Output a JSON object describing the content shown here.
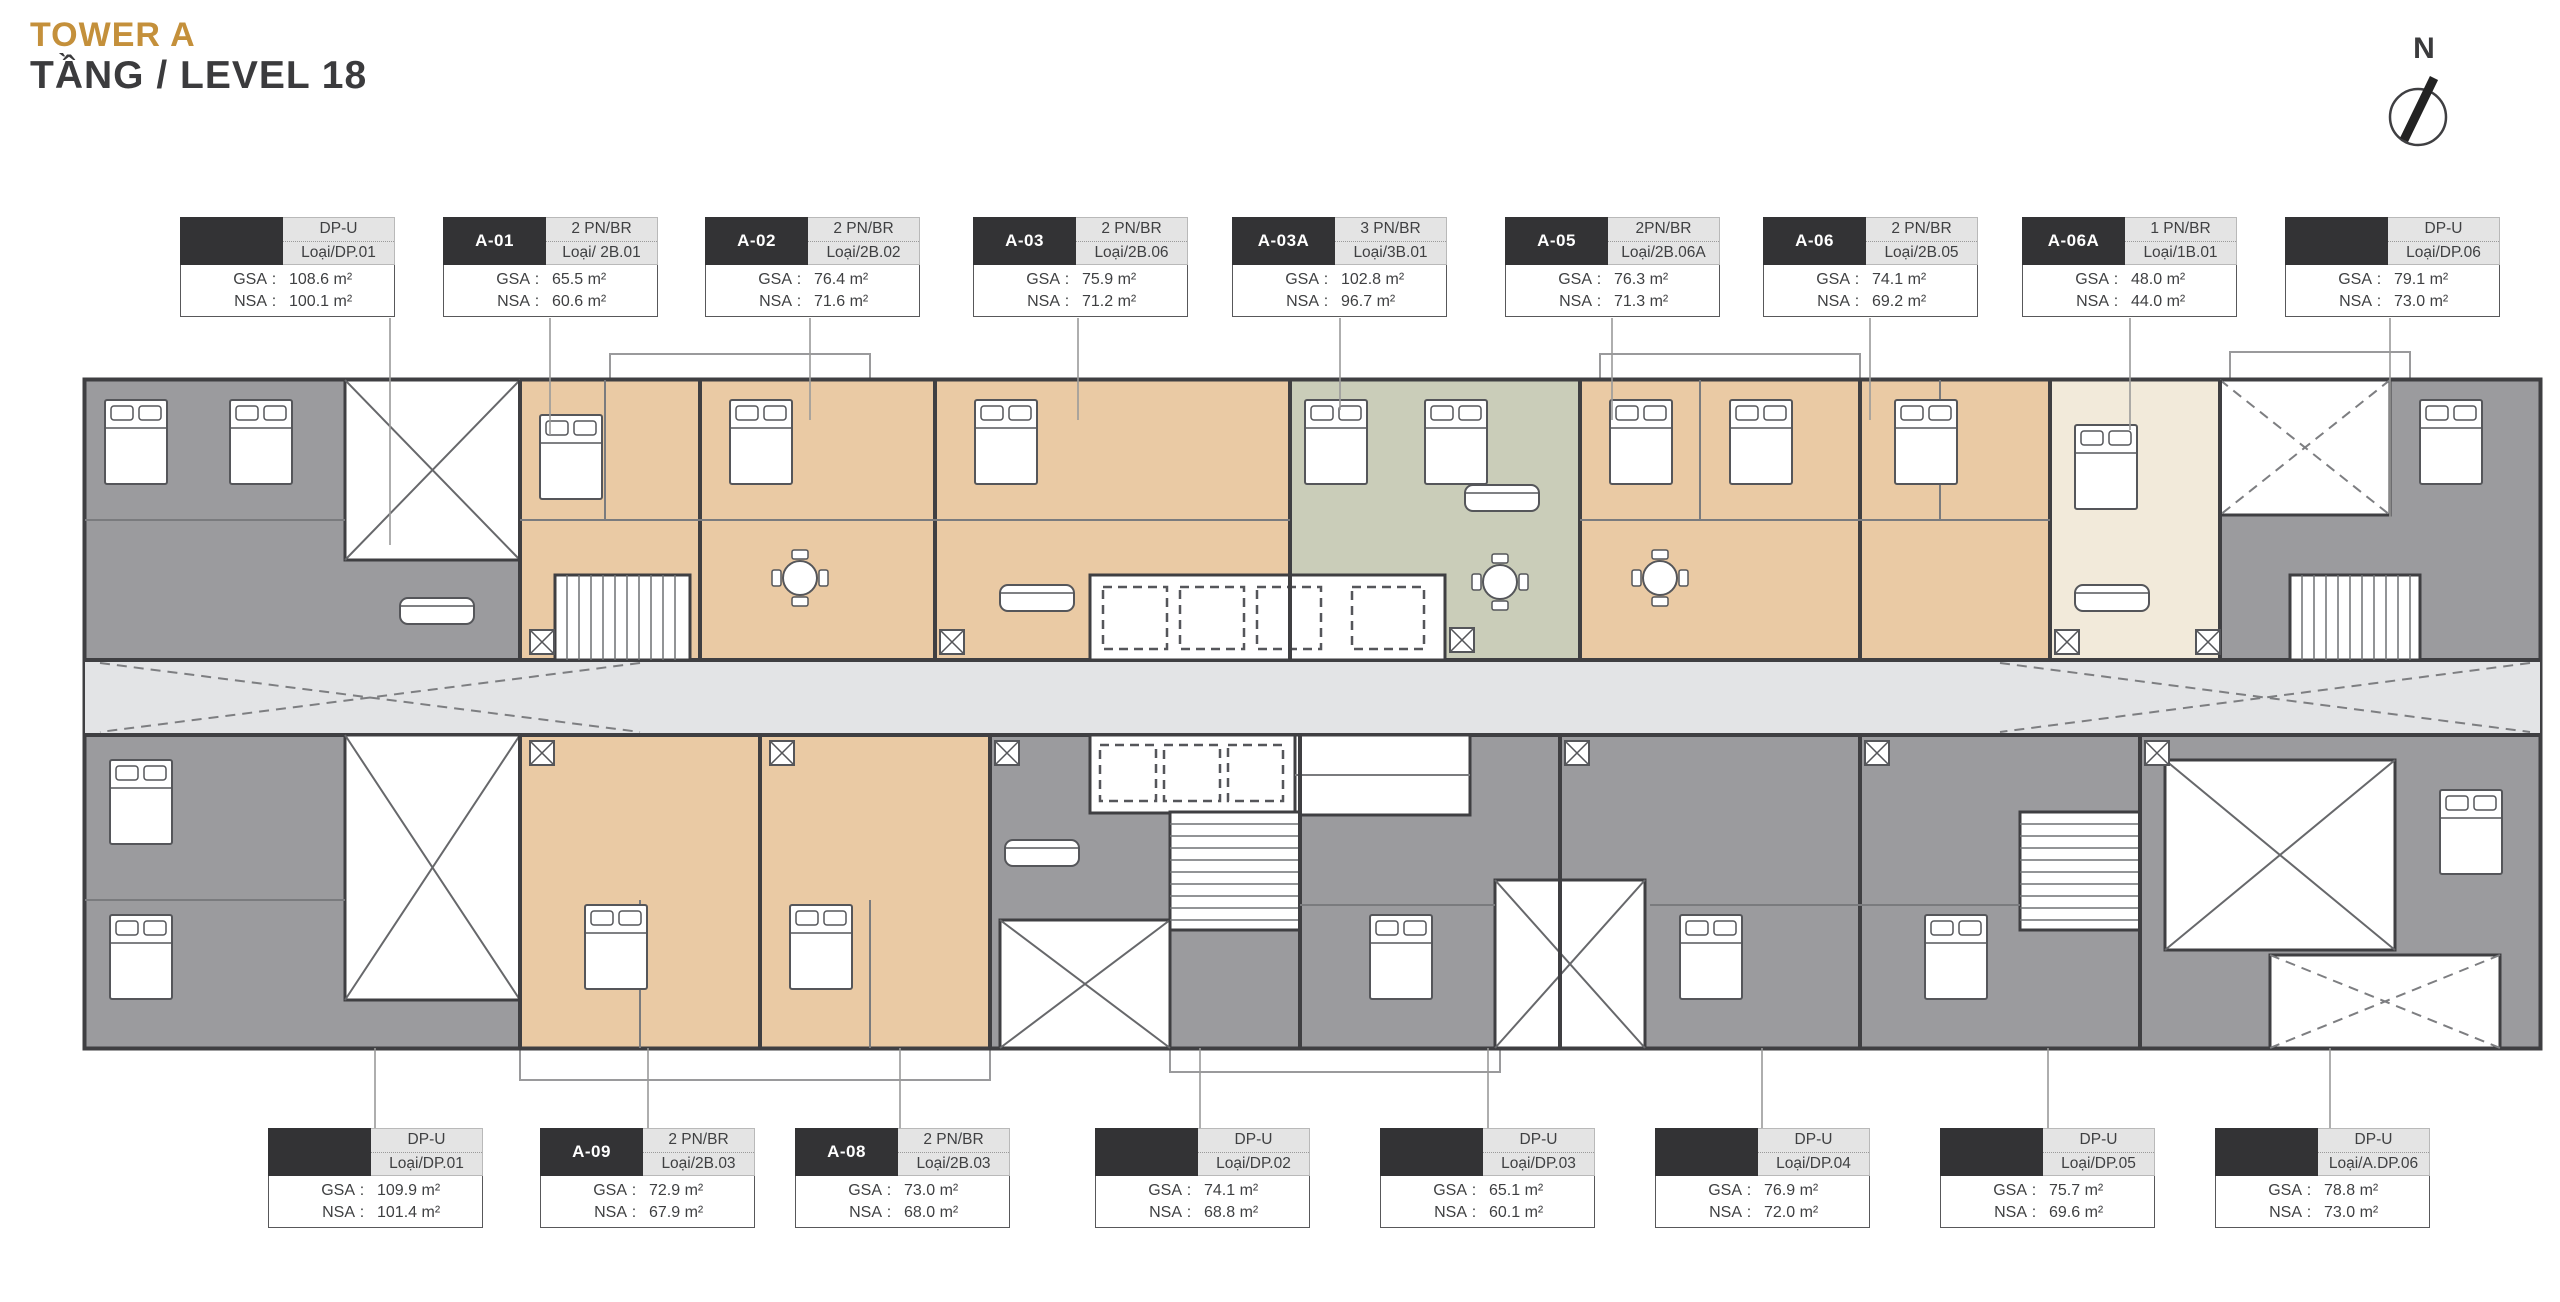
{
  "title": {
    "tower": "TOWER A",
    "level": "TẦNG / LEVEL 18"
  },
  "compass": {
    "label": "N"
  },
  "labels": {
    "gsa": "GSA",
    "nsa": "NSA"
  },
  "colors": {
    "accent_gold": "#C4903B",
    "title_text": "#3B3B3D",
    "wall_dark": "#3F3F42",
    "card_header_dark": "#333335",
    "card_header_light": "#E4E4E4",
    "unit_gray": "#9B9B9E",
    "unit_tan": "#EACAA4",
    "unit_sage": "#CACDB9",
    "unit_cream": "#F2EADA",
    "corridor_gray": "#E3E4E6",
    "leader_line": "#9A9A9A"
  },
  "top_cards": [
    {
      "code": "",
      "name": "DP-U",
      "type": "Loại/DP.01",
      "gsa": "108.6 m²",
      "nsa": "100.1 m²"
    },
    {
      "code": "A-01",
      "name": "2 PN/BR",
      "type": "Loại/ 2B.01",
      "gsa": "65.5 m²",
      "nsa": "60.6 m²"
    },
    {
      "code": "A-02",
      "name": "2 PN/BR",
      "type": "Loại/2B.02",
      "gsa": "76.4 m²",
      "nsa": "71.6 m²"
    },
    {
      "code": "A-03",
      "name": "2 PN/BR",
      "type": "Loại/2B.06",
      "gsa": "75.9 m²",
      "nsa": "71.2 m²"
    },
    {
      "code": "A-03A",
      "name": "3 PN/BR",
      "type": "Loại/3B.01",
      "gsa": "102.8 m²",
      "nsa": "96.7 m²"
    },
    {
      "code": "A-05",
      "name": "2PN/BR",
      "type": "Loại/2B.06A",
      "gsa": "76.3 m²",
      "nsa": "71.3 m²"
    },
    {
      "code": "A-06",
      "name": "2 PN/BR",
      "type": "Loại/2B.05",
      "gsa": "74.1 m²",
      "nsa": "69.2 m²"
    },
    {
      "code": "A-06A",
      "name": "1 PN/BR",
      "type": "Loại/1B.01",
      "gsa": "48.0 m²",
      "nsa": "44.0 m²"
    },
    {
      "code": "",
      "name": "DP-U",
      "type": "Loại/DP.06",
      "gsa": "79.1 m²",
      "nsa": "73.0 m²"
    }
  ],
  "bottom_cards": [
    {
      "code": "",
      "name": "DP-U",
      "type": "Loại/DP.01",
      "gsa": "109.9 m²",
      "nsa": "101.4 m²"
    },
    {
      "code": "A-09",
      "name": "2 PN/BR",
      "type": "Loại/2B.03",
      "gsa": "72.9 m²",
      "nsa": "67.9 m²"
    },
    {
      "code": "A-08",
      "name": "2 PN/BR",
      "type": "Loại/2B.03",
      "gsa": "73.0 m²",
      "nsa": "68.0 m²"
    },
    {
      "code": "",
      "name": "DP-U",
      "type": "Loại/DP.02",
      "gsa": "74.1 m²",
      "nsa": "68.8 m²"
    },
    {
      "code": "",
      "name": "DP-U",
      "type": "Loại/DP.03",
      "gsa": "65.1 m²",
      "nsa": "60.1 m²"
    },
    {
      "code": "",
      "name": "DP-U",
      "type": "Loại/DP.04",
      "gsa": "76.9 m²",
      "nsa": "72.0 m²"
    },
    {
      "code": "",
      "name": "DP-U",
      "type": "Loại/DP.05",
      "gsa": "75.7 m²",
      "nsa": "69.6 m²"
    },
    {
      "code": "",
      "name": "DP-U",
      "type": "Loại/A.DP.06",
      "gsa": "78.8 m²",
      "nsa": "73.0 m²"
    }
  ]
}
